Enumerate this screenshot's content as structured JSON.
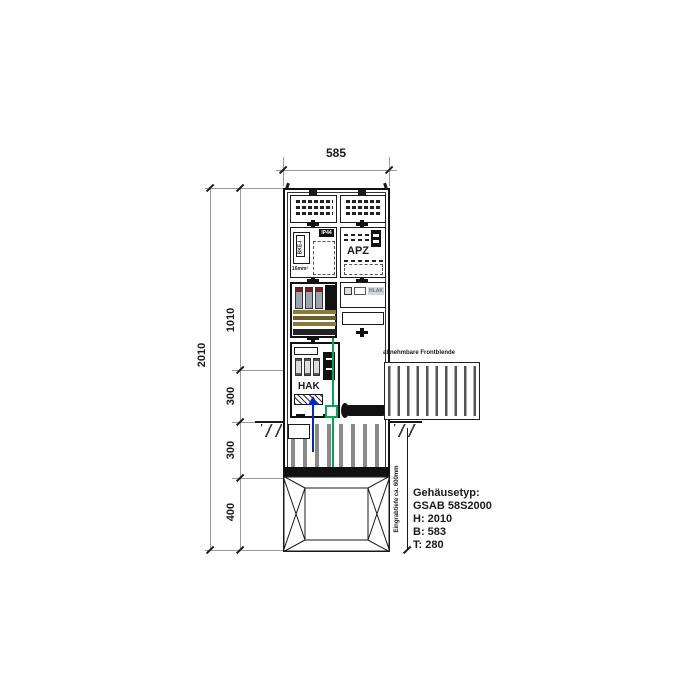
{
  "dimensions": {
    "top_width": "585",
    "total_height": "2010",
    "segments": [
      "1010",
      "300",
      "300",
      "400"
    ]
  },
  "labels": {
    "apz": "APZ",
    "hak": "HAK",
    "hlak": "HLAK",
    "bke": "BKE-I",
    "ip_rating": "IP44",
    "wire_gauge": "16mm²",
    "front_panel": "abnehmbare Frontblende",
    "burial_depth": "Eingrabtiefe ca. 600mm"
  },
  "spec": {
    "lines": [
      "Gehäusetyp:",
      "GSAB 58S2000",
      "H: 2010",
      "B: 583",
      "T: 280"
    ]
  },
  "colors": {
    "line": "#1a1a1a",
    "dim_line": "#9a9a9a",
    "pe_green": "#00a651",
    "cable_blue": "#0026cc",
    "busbar_olive": "#8a7a3a",
    "fuse_gray": "#9aa4b5",
    "fuse_cap_red": "#7a1f1f"
  }
}
